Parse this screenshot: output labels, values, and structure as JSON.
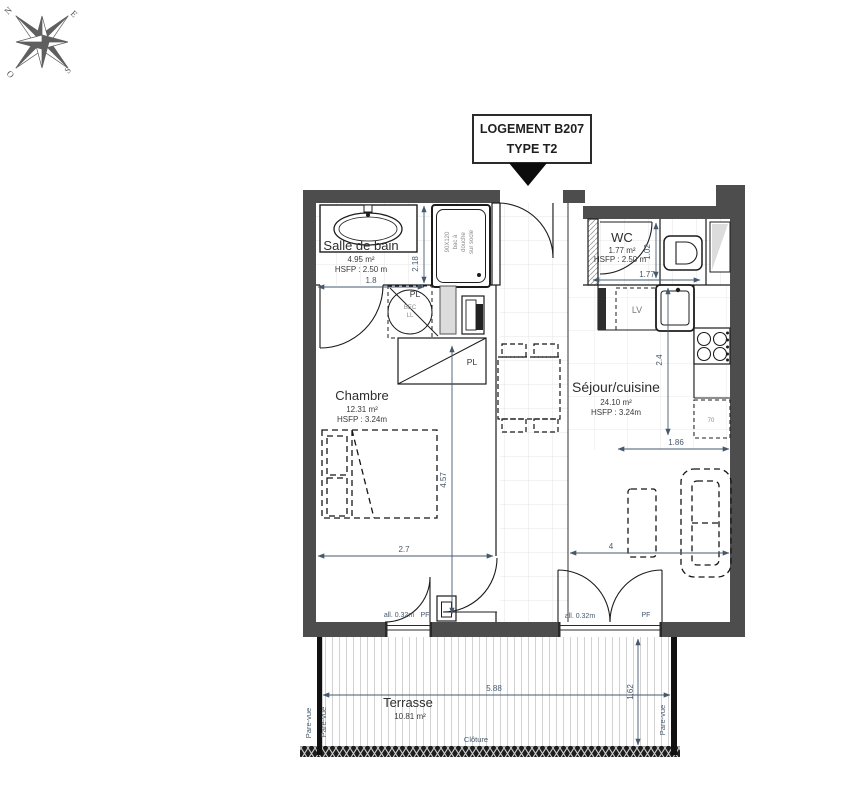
{
  "title": {
    "line1": "LOGEMENT B207",
    "line2": "TYPE T2"
  },
  "compass": {
    "n": "N",
    "e": "E",
    "o": "O",
    "s": "S"
  },
  "rooms": {
    "bathroom": {
      "name": "Salle de bain",
      "area": "4.95 m²",
      "ceiling": "HSFP : 2.50 m"
    },
    "wc": {
      "name": "WC",
      "area": "1.77 m²",
      "ceiling": "HSFP : 2.50 m"
    },
    "bedroom": {
      "name": "Chambre",
      "area": "12.31 m²",
      "ceiling": "HSFP : 3.24m"
    },
    "living": {
      "name": "Séjour/cuisine",
      "area": "24.10 m²",
      "ceiling": "HSFP : 3.24m"
    },
    "terrace": {
      "name": "Terrasse",
      "area": "10.81 m²"
    }
  },
  "fixtures": {
    "shower_l1": "90X120",
    "shower_l2": "bac à",
    "shower_l3": "douche",
    "shower_l4": "sur socle",
    "washer_l1": "BEC",
    "washer_l2": "LL",
    "closet_top": "PL",
    "closet_main": "PL",
    "dishwasher": "LV",
    "fridge": "70"
  },
  "openings": {
    "sill_left": "all. 0.32m",
    "pf_left": "PF",
    "sill_right": "all. 0.32m",
    "pf_right": "PF"
  },
  "site": {
    "fence": "Clôture",
    "screen_left_outer": "Pare-vue",
    "screen_left_inner": "Pare-vue",
    "screen_right": "Pare-vue"
  },
  "dimensions": {
    "bath_width": "1.8",
    "bath_depth": "2.18",
    "wc_width": "1.77",
    "wc_depth": "1.02",
    "bedroom_width": "2.7",
    "bedroom_depth": "4.57",
    "kitchen_depth": "2.4",
    "living_width": "4",
    "living_right": "1.86",
    "terrace_width": "5.88",
    "terrace_depth": "1.62"
  }
}
